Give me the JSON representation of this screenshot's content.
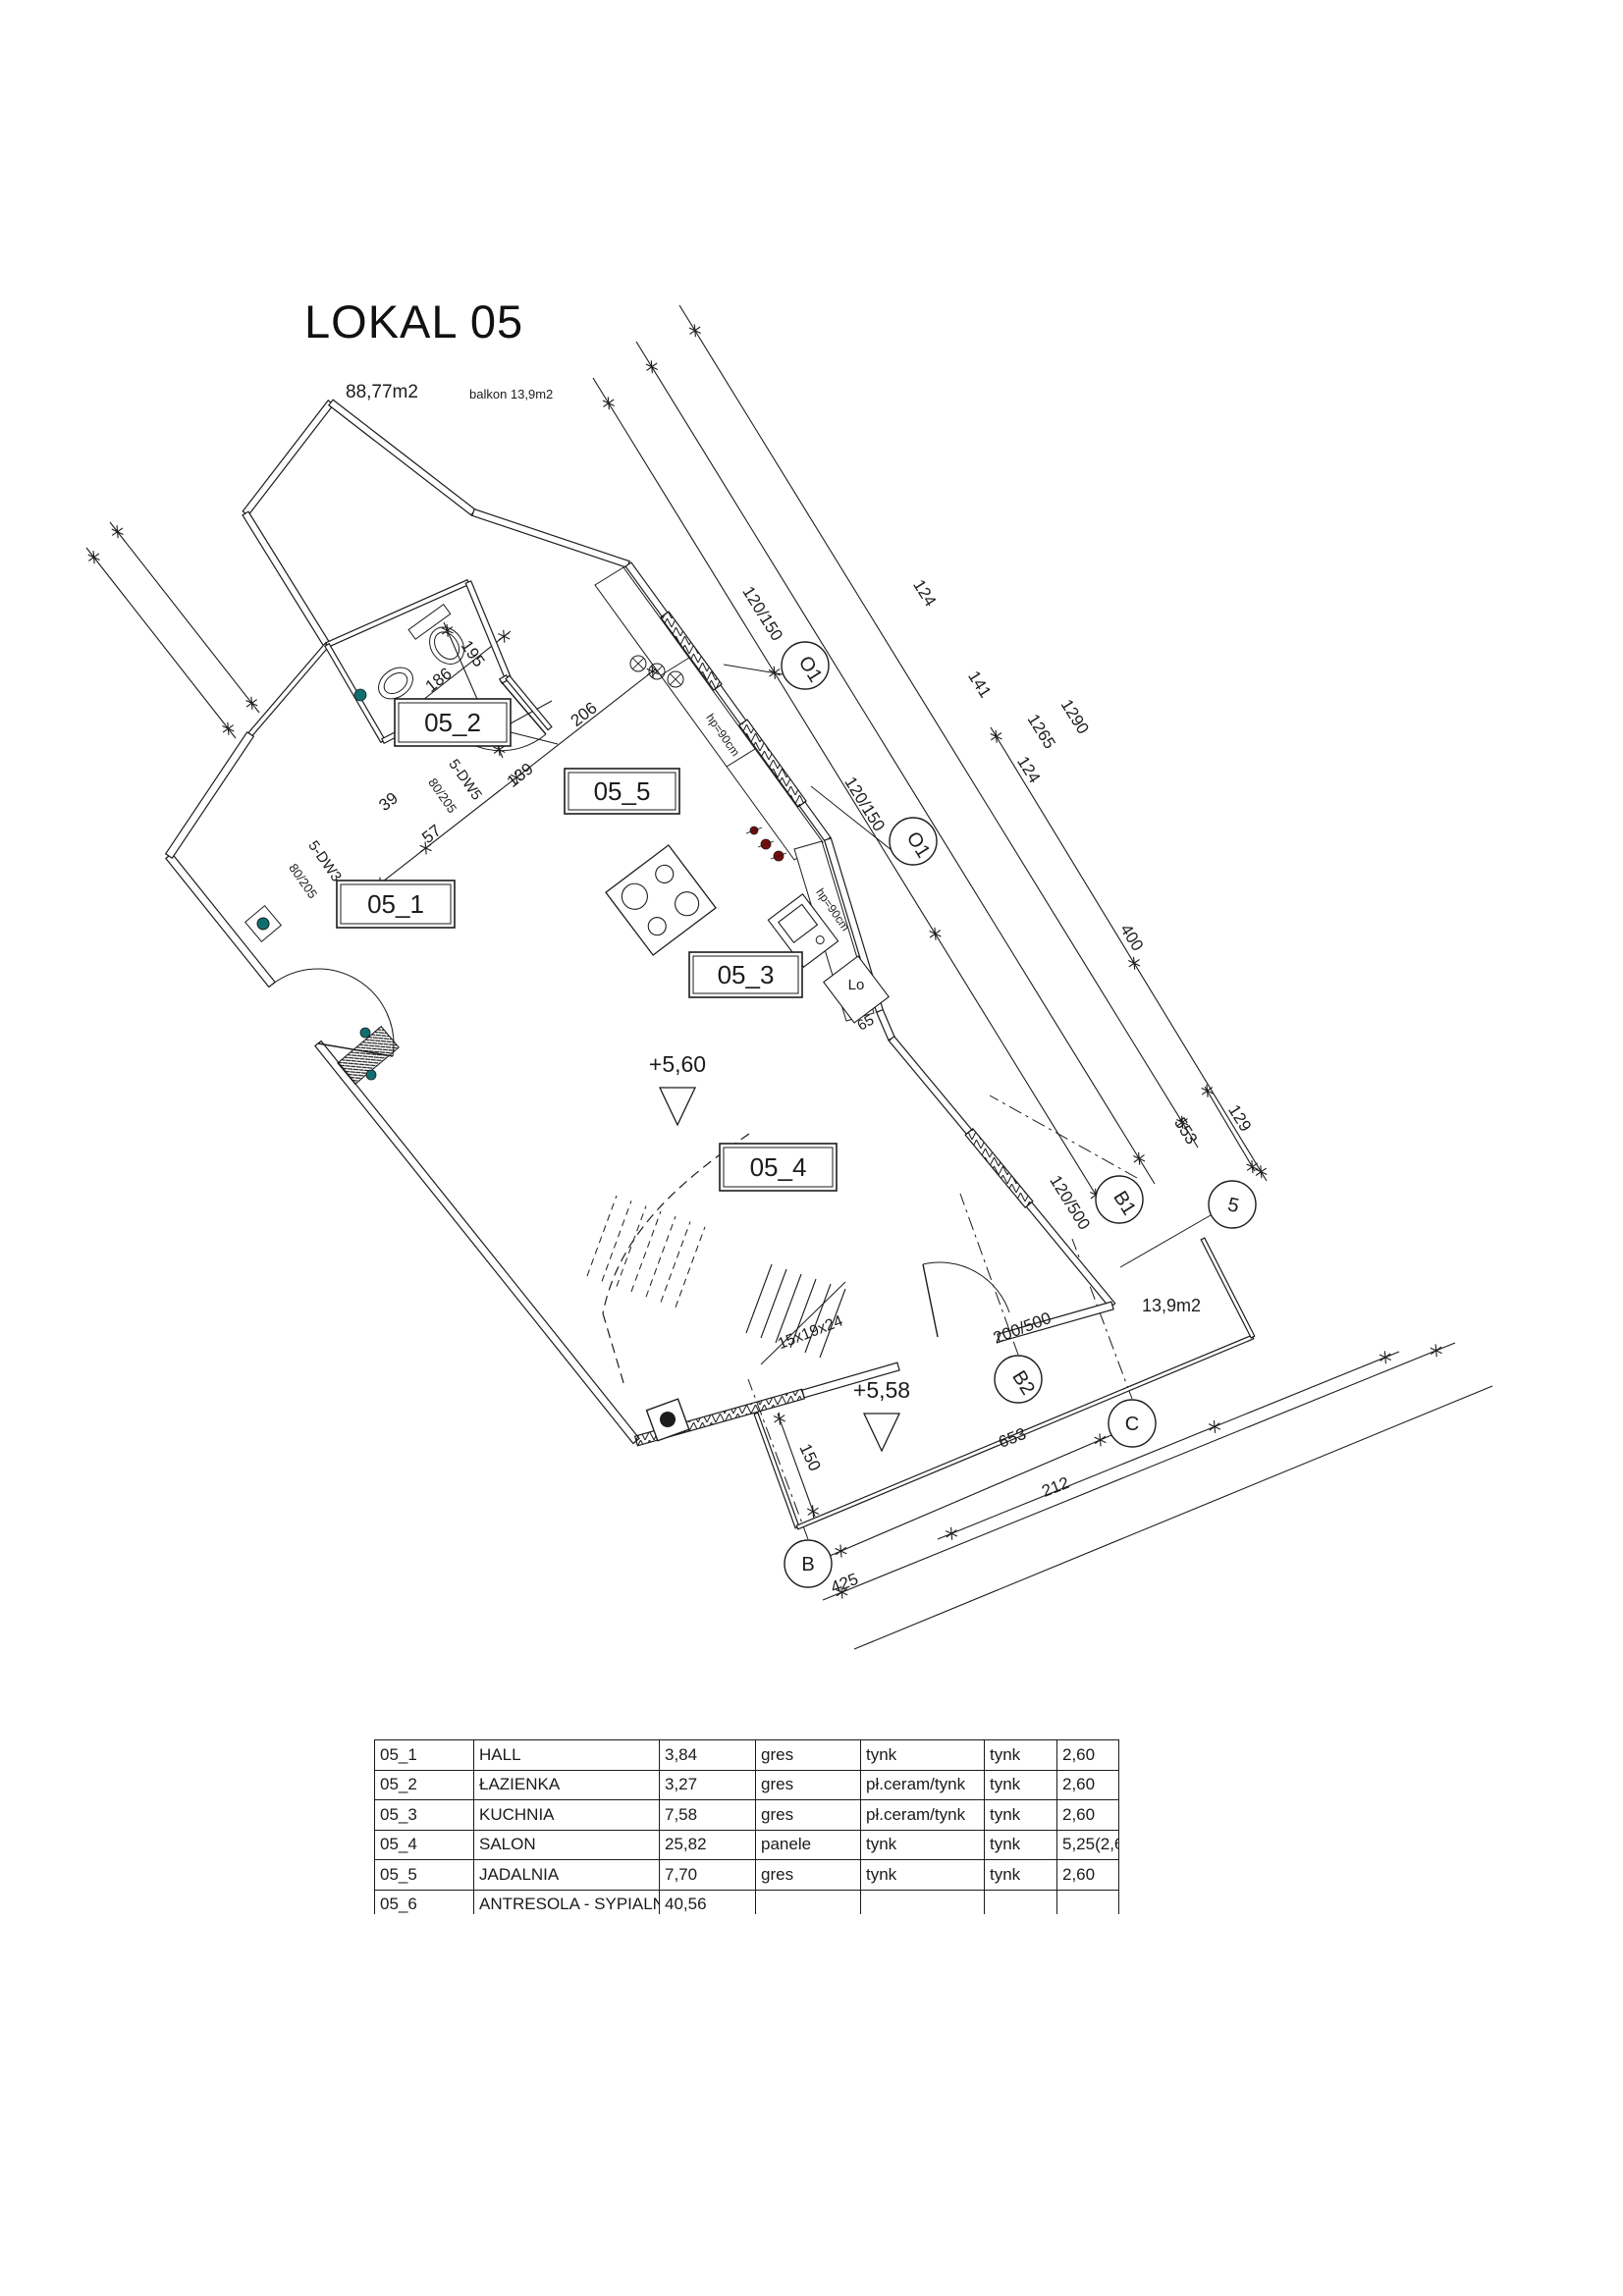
{
  "title": {
    "name": "LOKAL 05",
    "area": "88,77m2",
    "balcony_note": "balkon 13,9m2"
  },
  "plan": {
    "room_labels": {
      "r051": "05_1",
      "r052": "05_2",
      "r053": "05_3",
      "r054": "05_4",
      "r055": "05_5"
    },
    "axis_bubbles": {
      "o1a": "O1",
      "o1b": "O1",
      "b1": "B1",
      "b2": "B2",
      "n5": "5",
      "c": "C",
      "b": "B"
    },
    "levels": {
      "lv1": "+5,60",
      "lv2": "+5,58"
    },
    "dim_labels": {
      "d124a": "124",
      "d141": "141",
      "d124b": "124",
      "d1265": "1265",
      "d1290": "1290",
      "d400": "400",
      "d553": "553",
      "d129": "129",
      "d653": "653",
      "d212": "212",
      "d425": "425",
      "d150": "150",
      "d186": "186",
      "d195": "195",
      "d139": "139",
      "d206": "206",
      "d57": "57",
      "d39": "39",
      "d65": "65"
    },
    "opening_labels": {
      "w1a": "120/150",
      "w1b": "120/150",
      "wb1": "120/500",
      "wb2": "200/500",
      "dw5": "5-DW5",
      "dw5s": "80/205",
      "dw3": "5-DW3",
      "dw3s": "80/205",
      "hp1": "hp=90cm",
      "hp2": "hp=90cm"
    },
    "annotations": {
      "st": "15x19x24",
      "lo": "Lo",
      "ba": "13,9m2"
    }
  },
  "table": {
    "rows": [
      [
        "05_1",
        "HALL",
        "3,84",
        "gres",
        "tynk",
        "tynk",
        "2,60"
      ],
      [
        "05_2",
        "ŁAZIENKA",
        "3,27",
        "gres",
        "pł.ceram/tynk",
        "tynk",
        "2,60"
      ],
      [
        "05_3",
        "KUCHNIA",
        "7,58",
        "gres",
        "pł.ceram/tynk",
        "tynk",
        "2,60"
      ],
      [
        "05_4",
        "SALON",
        "25,82",
        "panele",
        "tynk",
        "tynk",
        "5,25(2,60)"
      ],
      [
        "05_5",
        "JADALNIA",
        "7,70",
        "gres",
        "tynk",
        "tynk",
        "2,60"
      ],
      [
        "05_6",
        "ANTRESOLA - SYPIALNIA",
        "40,56",
        "",
        "",
        "",
        ""
      ]
    ]
  },
  "colors": {
    "ink": "#1c1c1c",
    "outlet": "#7d0b0b",
    "switch": "#0f6f6f"
  }
}
